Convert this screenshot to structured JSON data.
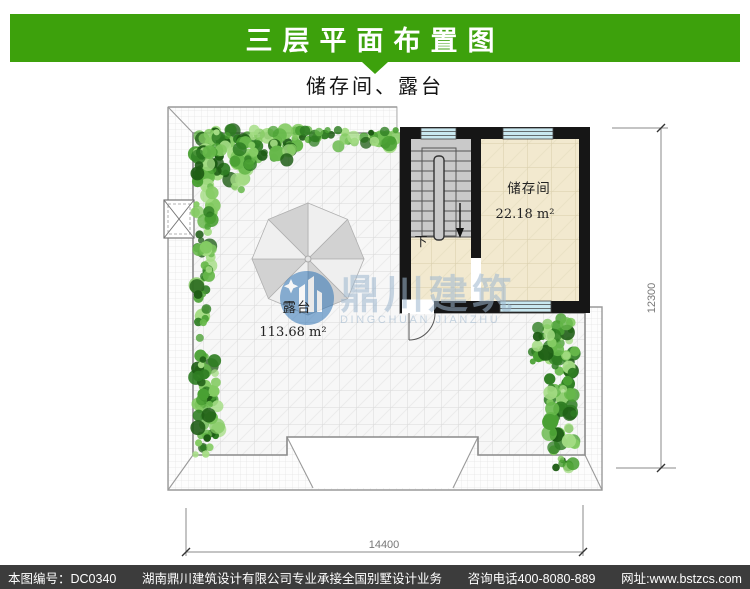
{
  "header": {
    "title": "三层平面布置图",
    "subtitle": "储存间、露台"
  },
  "plan": {
    "storage_room": {
      "name": "储存间",
      "area": "22.18 m²"
    },
    "terrace": {
      "name": "露台",
      "area": "113.68 m²"
    },
    "stair_down_label": "下",
    "dim_width": "14400",
    "dim_height": "12300"
  },
  "watermark": {
    "logo_cn": "鼎川建筑",
    "logo_en": "DINGCHUAN JIANZHU"
  },
  "footer": {
    "drawing_no": "本图编号：DC0340",
    "company": "湖南鼎川建筑设计有限公司专业承接全国别墅设计业务",
    "phone": "咨询电话400-8080-889",
    "website": "网址:www.bstzcs.com"
  },
  "colors": {
    "accent_green": "#3da10c",
    "footer_bg": "#3c3c3c",
    "window_cyan": "#c9e8f0",
    "logo_blue": "#2f74b5"
  }
}
